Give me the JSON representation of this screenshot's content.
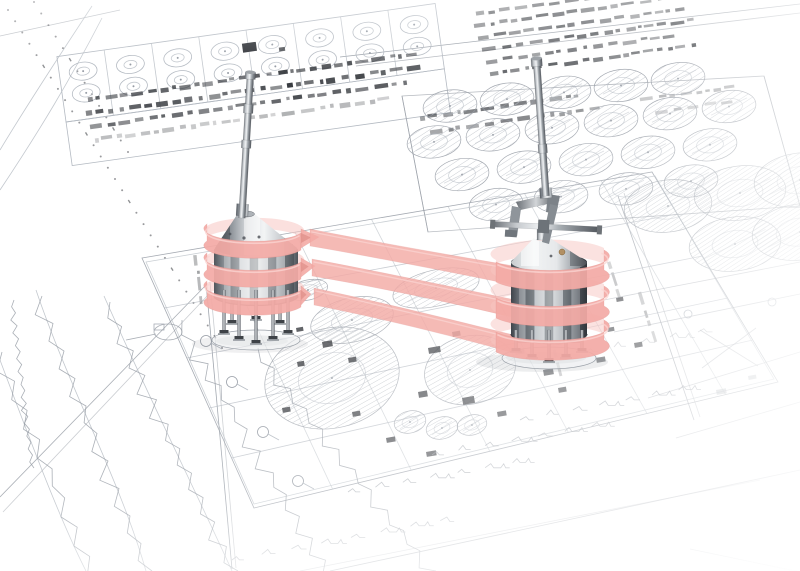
{
  "colors": {
    "background": "#ffffff",
    "blueprintLine": "#b4bac2",
    "blueprintMid": "#959ba4",
    "blueprintDark": "#33363b",
    "hatchLine": "#a6acb4",
    "ribbon": "#f4aba6",
    "ribbonLight": "#fbd6d3",
    "ribbonDark": "#db8781",
    "ribbonBack": "#f7c6c2",
    "metalDark": "#4d5258",
    "metalMid": "#9aa0a6",
    "metalLight": "#eef0f2",
    "brassDetail": "#b29064"
  },
  "scene": {
    "vessel_count": 2,
    "ribbon_bands_per_vessel": 3,
    "connector_bands": 3
  }
}
